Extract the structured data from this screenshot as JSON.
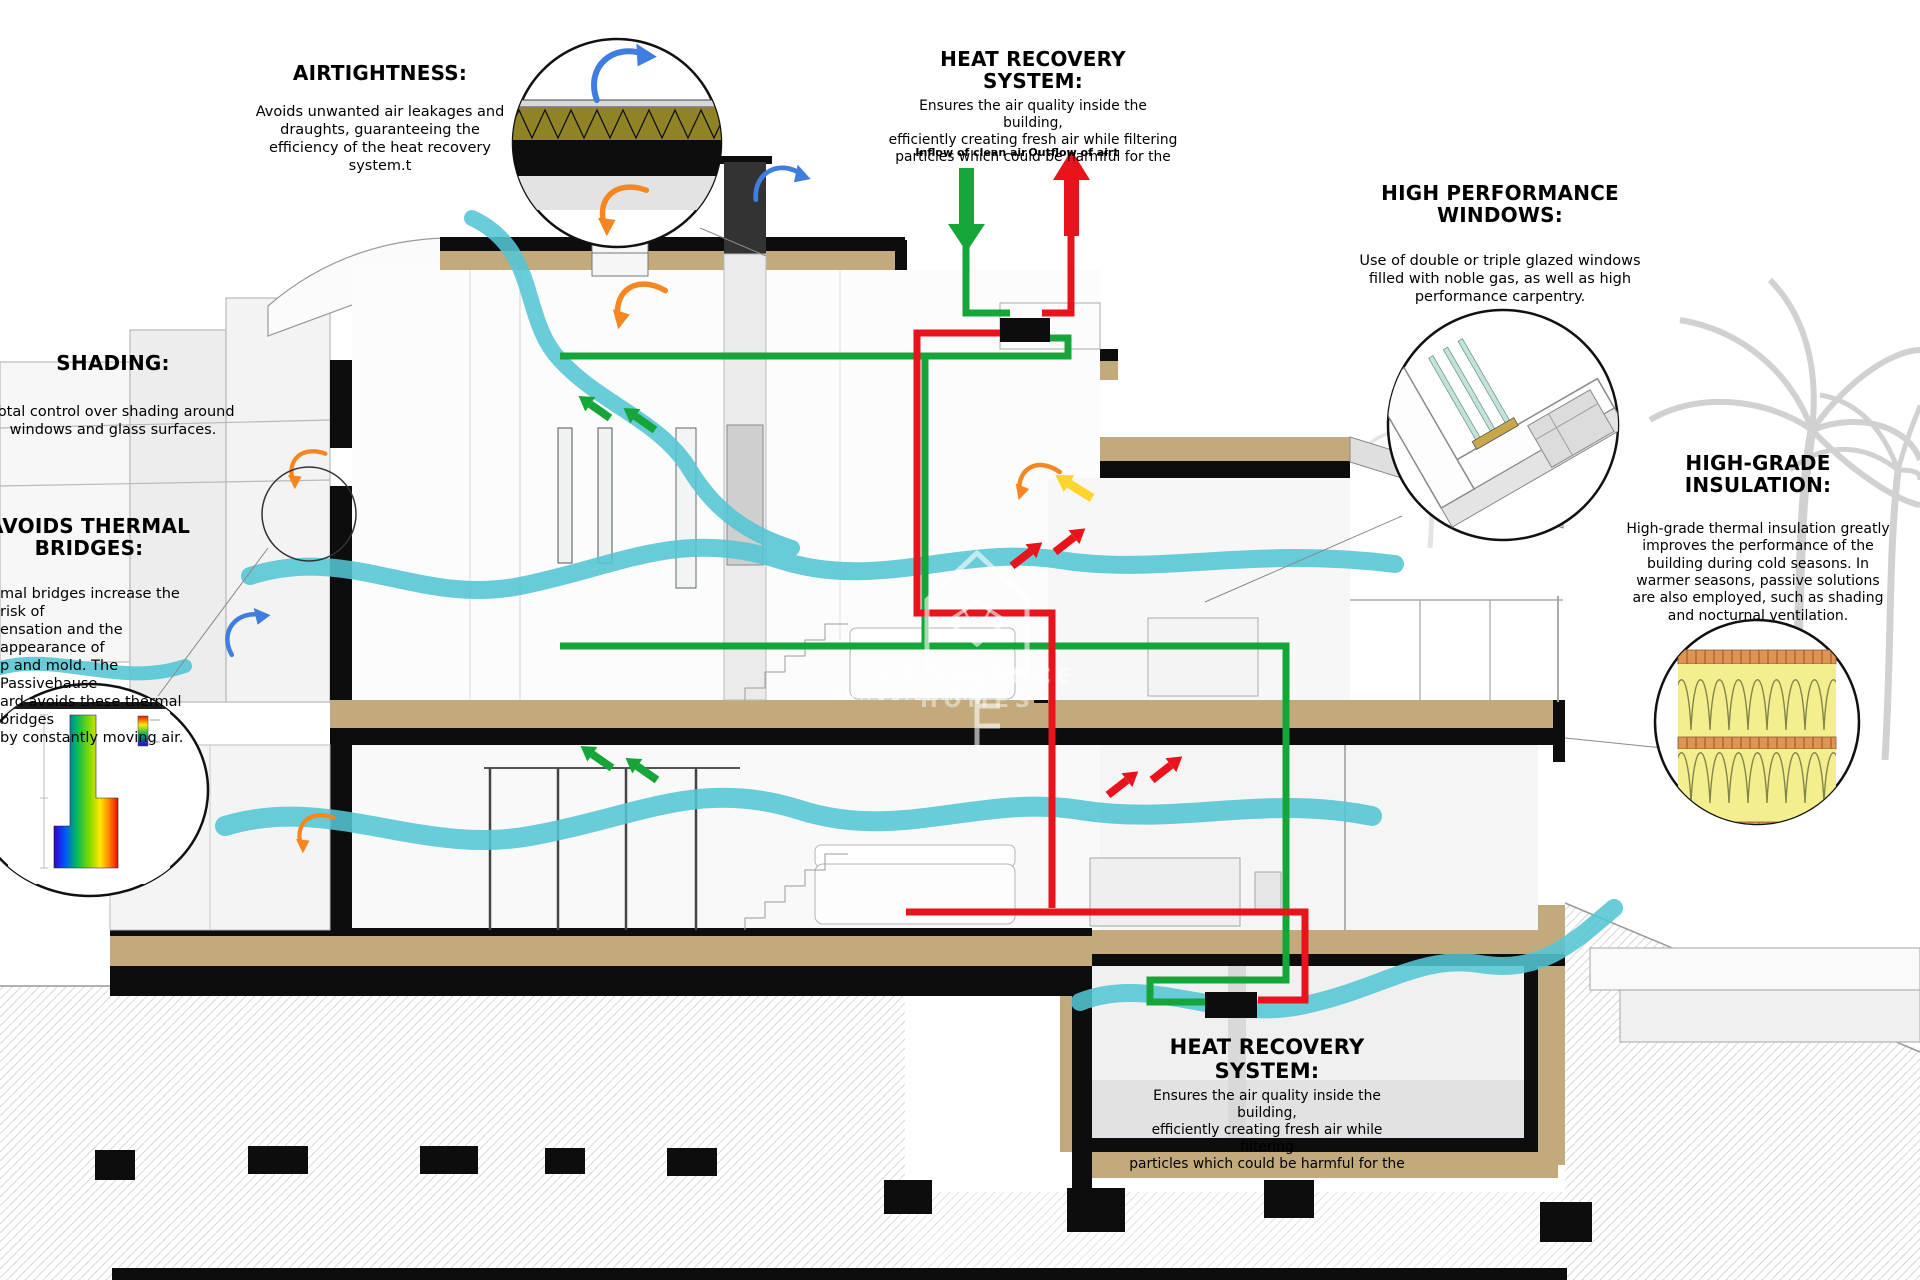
{
  "annotations": {
    "airtightness": {
      "title": "AIRTIGHTNESS:",
      "body": "Avoids unwanted air leakages and\ndraughts, guaranteeing the\nefficiency of the heat recovery\nsystem.t"
    },
    "heat_recovery_top": {
      "title": "HEAT RECOVERY SYSTEM:",
      "body": "Ensures the air quality inside the building,\nefficiently creating fresh air while filtering\nparticles which could be harmful for the",
      "inflow_label": "Inflow of clean air",
      "outflow_label": "Outflow of airt"
    },
    "high_performance_windows": {
      "title": "HIGH PERFORMANCE\nWINDOWS:",
      "body": "Use of double or triple glazed windows\nfilled with noble gas, as well as high\nperformance carpentry."
    },
    "shading": {
      "title": "SHADING:",
      "body": "Total control over shading around\nwindows and glass surfaces."
    },
    "avoids_thermal_bridges": {
      "title": "AVOIDS THERMAL\nBRIDGES:",
      "body": "mal bridges increase the risk of\nensation and the appearance of\np and mold. The Passivehause\nard avoids these thermal bridges\nby constantly moving air."
    },
    "high_grade_insulation": {
      "title": "HIGH-GRADE\nINSULATION:",
      "body": "High-grade thermal insulation greatly\nimproves the performance of the\nbuilding during cold seasons. In\nwarmer seasons, passive solutions\nare also employed, such as shading\nand nocturnal ventilation."
    },
    "heat_recovery_bottom": {
      "title": "HEAT RECOVERY SYSTEM:",
      "body": "Ensures the air quality inside the building,\nefficiently creating fresh air while filtering\nparticles which could be harmful for the"
    }
  },
  "watermark": {
    "brand": "BRILLIANCE HOMES",
    "subtitle": "INMOBILIARIA"
  },
  "colors": {
    "airflow_cyan": "#53c5d4",
    "supply_green": "#16a539",
    "exhaust_red": "#e8131b",
    "convection_orange": "#f6861f",
    "breeze_blue": "#3f7de0",
    "sun_yellow": "#ffd42c",
    "slab_tan": "#c3aa7c",
    "insulation_yellow": "#f4ef8e",
    "roof_insulation_olive": "#8f8326"
  }
}
